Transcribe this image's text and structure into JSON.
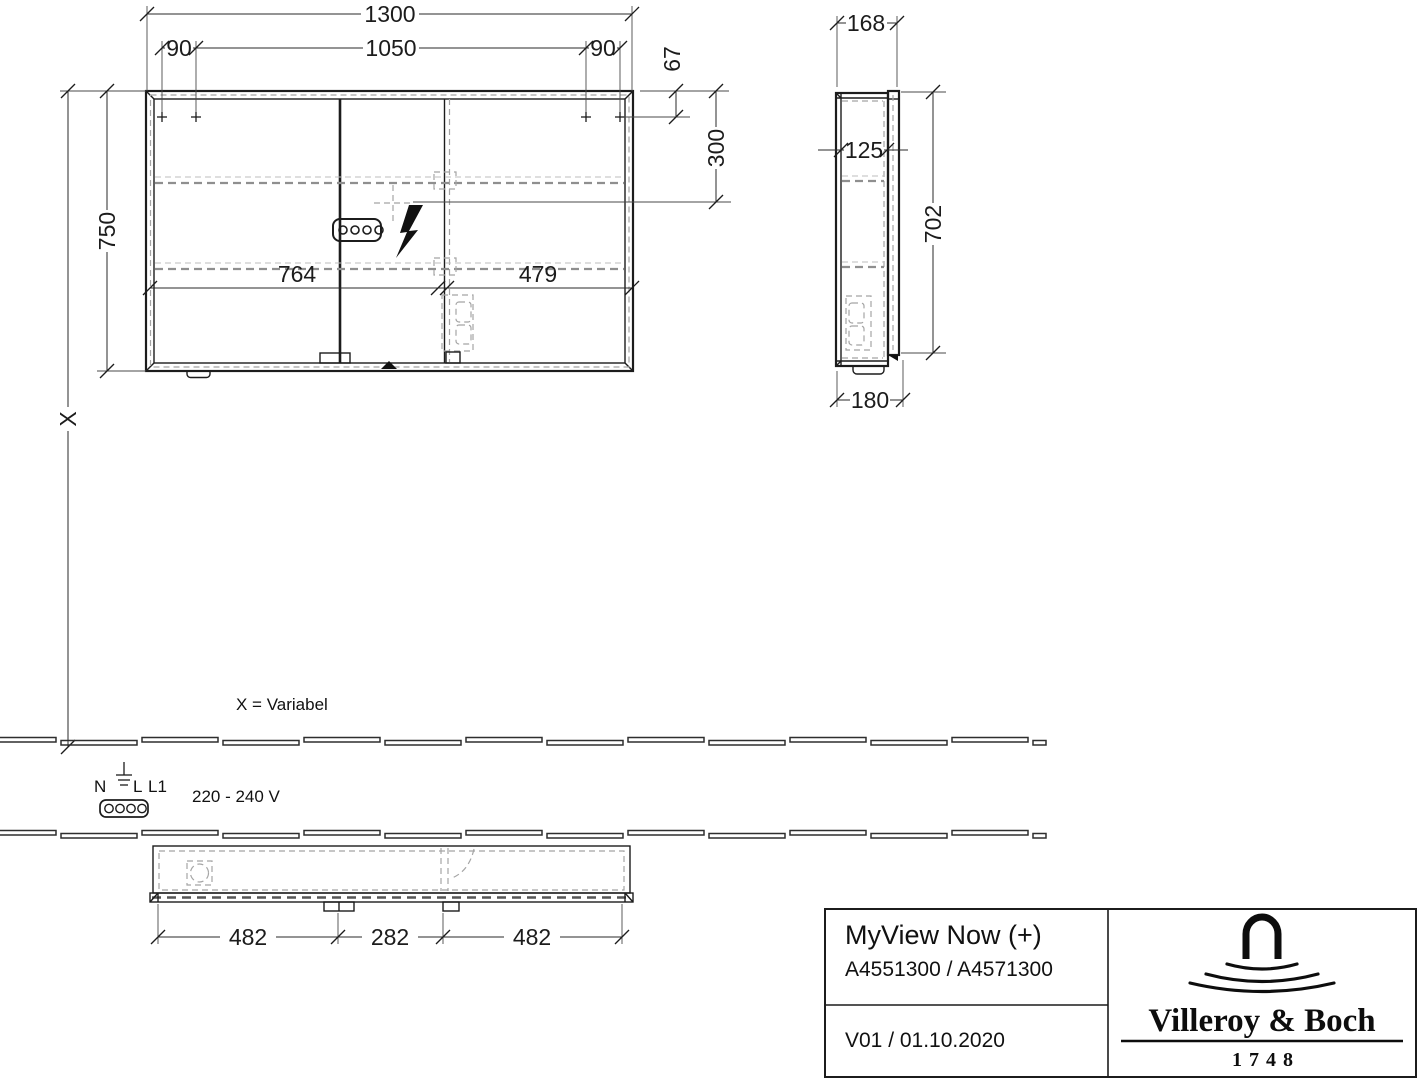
{
  "colors": {
    "background": "#ffffff",
    "line": "#1c1c1c",
    "hidden_dash": "#a5a5a5",
    "dim_text": "#1c1c1c"
  },
  "front_view": {
    "dim_total_width": "1300",
    "dim_inner_width": "1050",
    "dim_margin_left": "90",
    "dim_margin_right": "90",
    "dim_top_offset": "67",
    "dim_socket_height": "300",
    "dim_total_height": "750",
    "dim_variable": "X",
    "dim_door_left": "764",
    "dim_door_right": "479"
  },
  "side_view": {
    "dim_depth_top": "168",
    "dim_inner_depth": "125",
    "dim_door_height": "702",
    "dim_depth_bottom": "180"
  },
  "plan_view": {
    "dim_hinge_left": "482",
    "dim_hinge_center": "282",
    "dim_hinge_right": "482"
  },
  "annotations": {
    "x_note": "X = Variabel",
    "terminal_n": "N",
    "terminal_l": "L",
    "terminal_l1": "L1",
    "voltage": "220 - 240 V"
  },
  "title_block": {
    "product_name": "MyView Now (+)",
    "article_numbers": "A4551300 / A4571300",
    "version_date": "V01 / 01.10.2020",
    "brand_name": "Villeroy & Boch",
    "brand_year": "1748"
  }
}
